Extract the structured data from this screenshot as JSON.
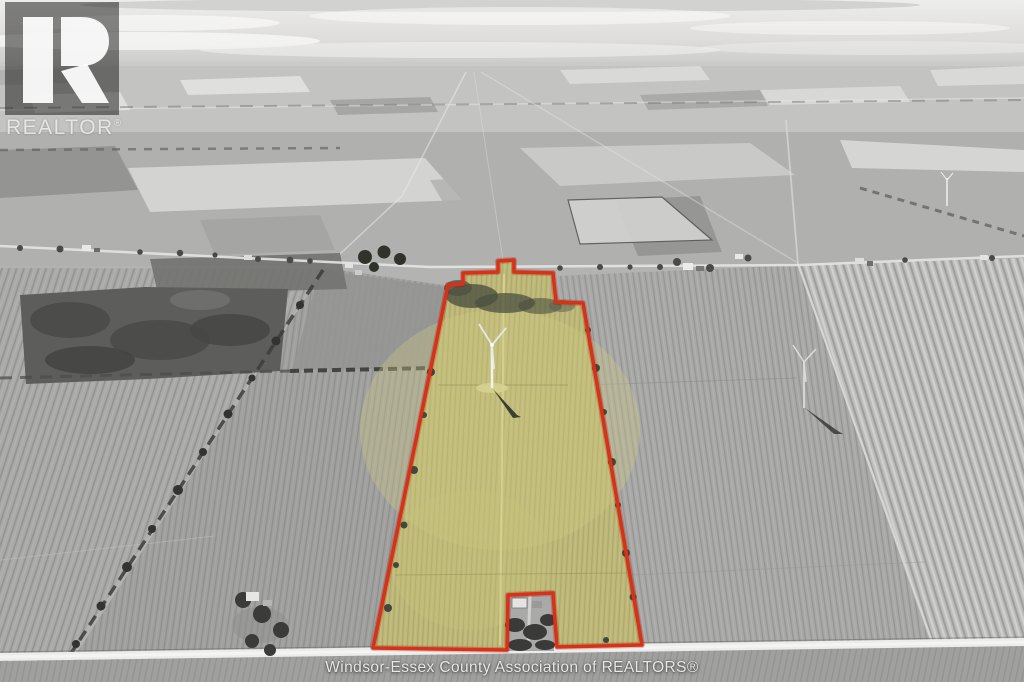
{
  "watermarks": {
    "logo_text": "REALTOR",
    "logo_reg": "®",
    "association_text": "Windsor-Essex County Association of REALTORS®"
  },
  "parcel": {
    "points": "448,285 463,284 463,273 498,272 498,261 514,260 514,272 553,273 556,302 583,303 642,645 557,647 553,593 508,595 507,650 373,648",
    "fill_color": "#bdb873",
    "texture_color": "#5b5520",
    "outline_color": "#d93018",
    "outline_glow_color": "#8e1408"
  }
}
